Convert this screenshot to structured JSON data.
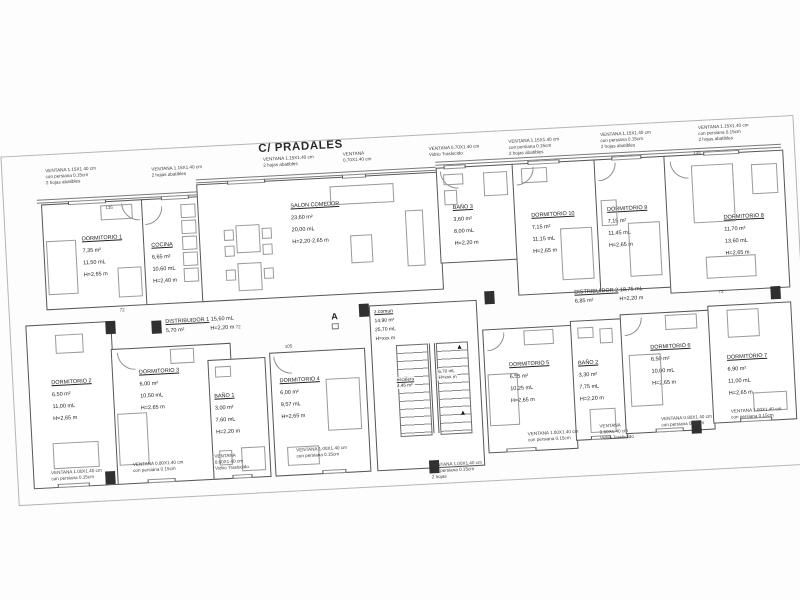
{
  "title": "C/ PRADALES",
  "section_marker": "A",
  "rooms": [
    {
      "name": "DORMITORIO 1",
      "area": "7,35 m²",
      "length": "11,50 mL",
      "height": "H=2,65 m"
    },
    {
      "name": "COCINA",
      "area": "6,65 m²",
      "length": "10,60 mL",
      "height": "H=2,40 m"
    },
    {
      "name": "SALON COMEDOR",
      "area": "23,60 m²",
      "length": "20,00 mL",
      "height": "H=2,20-2,65 m"
    },
    {
      "name": "BAÑO 3",
      "area": "3,60 m²",
      "length": "8,00 mL",
      "height": "H=2,20 m"
    },
    {
      "name": "DORMITORIO 10",
      "area": "7,15 m²",
      "length": "11,15 mL",
      "height": "H=2,65 m"
    },
    {
      "name": "DORMITORIO 9",
      "area": "7,15 m²",
      "length": "11,45 mL",
      "height": "H=2,65 m"
    },
    {
      "name": "DORMITORIO 8",
      "area": "11,70 m²",
      "length": "13,60 mL",
      "height": "H=2,65 m"
    },
    {
      "name": "DORMITORIO 2",
      "area": "6,50 m²",
      "length": "11,00 mL",
      "height": "H=2,65 m"
    },
    {
      "name": "DORMITORIO 3",
      "area": "6,00 m²",
      "length": "10,50 mL",
      "height": "H=2,65 m"
    },
    {
      "name": "BAÑO 1",
      "area": "3,00 m²",
      "length": "7,60 mL",
      "height": "H=2,20 m"
    },
    {
      "name": "DORMITORIO 4",
      "area": "6,00 m²",
      "length": "9,57 mL",
      "height": "H=2,65 m"
    },
    {
      "name": "DORMITORIO 5",
      "area": "6,55 m²",
      "length": "10,25 mL",
      "height": "H=2,65 m"
    },
    {
      "name": "BAÑO 2",
      "area": "3,30 m²",
      "length": "7,75 mL",
      "height": "H=2,20 m"
    },
    {
      "name": "DORMITORIO 6",
      "area": "6,50 m²",
      "length": "10,00 mL",
      "height": "H=2,65 m"
    },
    {
      "name": "DORMITORIO 7",
      "area": "6,90 m²",
      "length": "11,00 mL",
      "height": "H=2,65 m"
    }
  ],
  "distribuidor1": {
    "name": "DISTRIBUIDOR 1",
    "length": "15,60 mL",
    "area": "5,70 m²",
    "height": "H=2,20 m"
  },
  "distribuidor2": {
    "name": "DISTRIBUIDOR 2",
    "length": "18,75 mL",
    "area": "6,85 m²",
    "height": "H=2,20 m"
  },
  "zcomun": {
    "name": "z.comun",
    "area": "14,90 m²",
    "length": "25,70 mL",
    "height": "H=xxx m"
  },
  "escalera": {
    "name": "escalera",
    "area": "4,45 m²",
    "length": "6,70 mL",
    "height": "H=xxx m"
  },
  "window_notes": [
    {
      "l1": "VENTANA 1.15X1.40 cm",
      "l2": "con persiana 0.15cm",
      "l3": "2 hojas abatibles"
    },
    {
      "l1": "VENTANA 1.15X1.40 cm",
      "l2": "2 hojas abatibles"
    },
    {
      "l1": "VENTANA 1.15X1.40 cm",
      "l2": "2 hojas abatibles"
    },
    {
      "l1": "VENTANA",
      "l2": "0.70X1.40 cm"
    },
    {
      "l1": "VENTANA 0.70X1.40 cm",
      "l2": "Vidrio Traslucido"
    },
    {
      "l1": "VENTANA 1.15X1.40 cm",
      "l2": "con persiana 0.15cm",
      "l3": "2 hojas abatibles"
    },
    {
      "l1": "VENTANA 1.15X1.40 cm",
      "l2": "con persiana 0.15cm",
      "l3": "2 hojas abatibles"
    },
    {
      "l1": "VENTANA 1.15X1.40 cm",
      "l2": "con persiana 0.15cm",
      "l3": "2 hojas abatibles"
    },
    {
      "l1": "VENTANA 1.00X1.40 cm",
      "l2": "con persiana 0.15cm"
    },
    {
      "l1": "VENTANA 0.80X1.40 cm",
      "l2": "con persiana 0.15cm"
    },
    {
      "l1": "VENTANA",
      "l2": "0.60X1.40 cm",
      "l3": "Vidrio Traslucido"
    },
    {
      "l1": "VENTANA 1.00X1.40 cm",
      "l2": "con persiana 0.15cm"
    },
    {
      "l1": "VENTANA 1.00X1.40 cm",
      "l2": "con persiana 0.15cm",
      "l3": "2 hojas"
    },
    {
      "l1": "VENTANA 1.00X1.40 cm",
      "l2": "con persiana 0.15cm"
    },
    {
      "l1": "VENTANA",
      "l2": "0.60X1.40 cm",
      "l3": "Vidrio Traslucido"
    },
    {
      "l1": "VENTANA 0.80X1.40 cm",
      "l2": "con persiana 0.15cm"
    },
    {
      "l1": "VENTANA 1.00X1.40 cm",
      "l2": "con persiana 0.15cm"
    }
  ],
  "door_labels": [
    "135",
    "135",
    "105",
    "72",
    "72",
    "72"
  ]
}
